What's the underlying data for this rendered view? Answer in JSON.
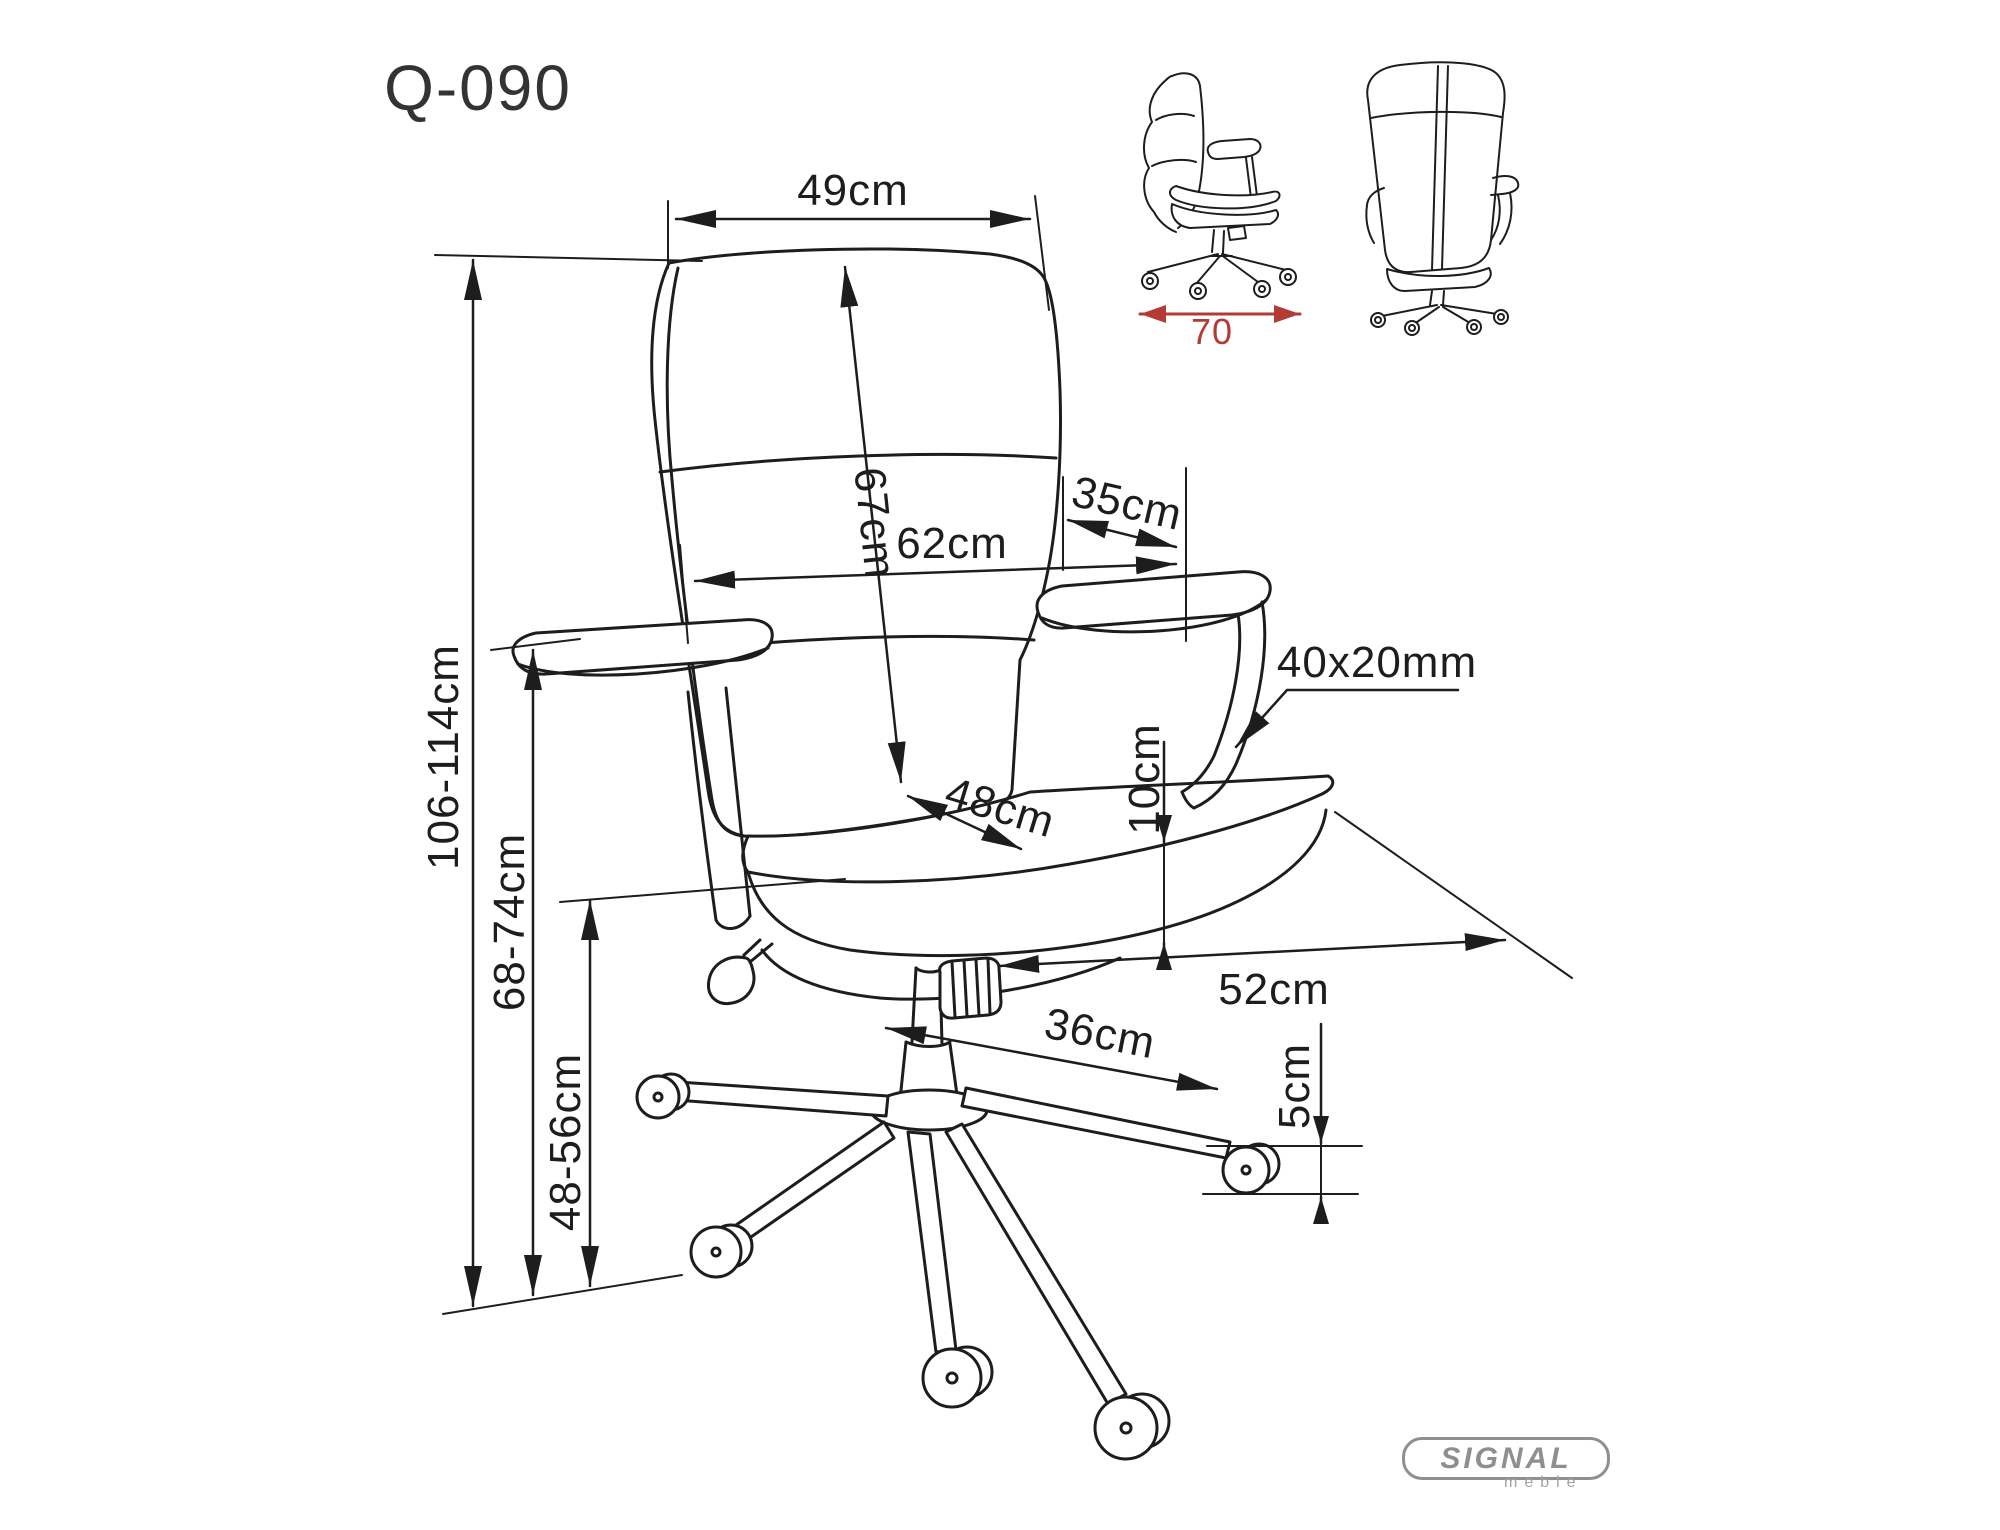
{
  "title": "Q-090",
  "dims": {
    "backrest_width": "49cm",
    "backrest_height": "67cm",
    "overall_width": "62cm",
    "armrest_pad_length": "35cm",
    "armrest_profile": "40x20mm",
    "seat_cushion_thickness": "10cm",
    "seat_depth": "48cm",
    "base_depth": "52cm",
    "base_leg_length": "36cm",
    "caster_height": "5cm",
    "overall_height": "106-114cm",
    "armrest_height": "68-74cm",
    "seat_height": "48-56cm",
    "footprint_width": "70"
  },
  "logo": {
    "brand": "SIGNAL",
    "subtitle": "meble"
  },
  "colors": {
    "line": "#1d1d1d",
    "accent_red": "#b23b35",
    "logo_gray": "#8f8f8f"
  }
}
